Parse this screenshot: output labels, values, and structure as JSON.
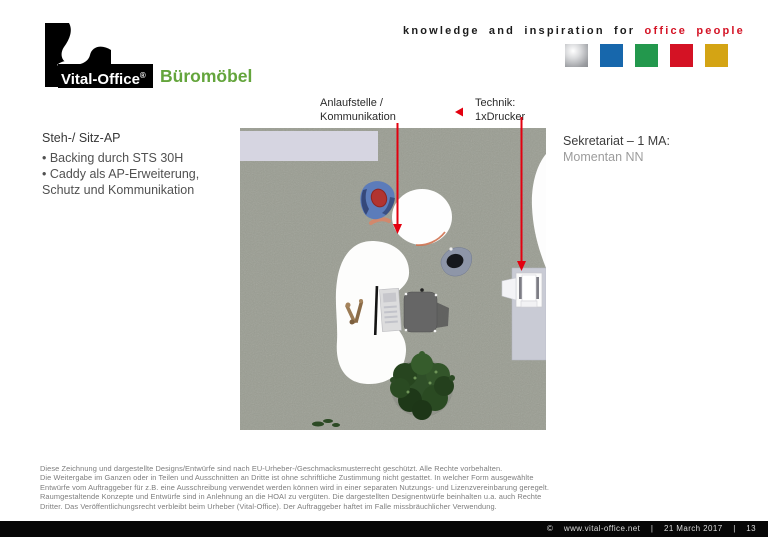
{
  "header": {
    "logo_brand": "Vital-Office",
    "logo_reg": "®",
    "logo_suffix": "Büromöbel",
    "tagline_black": "knowledge and inspiration for",
    "tagline_red": "office people",
    "palette_squares": [
      "silver",
      "blue",
      "green",
      "red",
      "gold"
    ]
  },
  "left_panel": {
    "title": "Steh-/ Sitz-AP",
    "lines": [
      "•  Backing durch STS 30H",
      "• Caddy als AP-Erweiterung,",
      "Schutz und Kommunikation"
    ]
  },
  "right_panel": {
    "title": "Sekretariat – 1 MA:",
    "subtitle": "Momentan NN"
  },
  "callouts": {
    "anlaufstelle_line1": "Anlaufstelle /",
    "anlaufstelle_line2": "Kommunikation",
    "technik_line1": "Technik:",
    "technik_line2": "1xDrucker"
  },
  "disclaimer": {
    "lines": [
      "Diese Zeichnung und dargestellte Designs/Entwürfe sind nach EU-Urheber-/Geschmacksmusterrecht geschützt. Alle Rechte vorbehalten.",
      "Die Weitergabe im Ganzen oder in Teilen und Ausschnitten an Dritte ist ohne schriftliche Zustimmung nicht gestattet. In welcher Form ausgewählte",
      "Entwürfe vom Auftraggeber für z.B. eine Ausschreibung verwendet werden können wird in einer separaten Nutzungs- und Lizenzvereinbarung geregelt.",
      "Raumgestaltende Konzepte und Entwürfe sind in Anlehnung an die HOAI zu vergüten. Die dargestellten Designentwürfe beinhalten u.a. auch Rechte",
      "Dritter. Das Veröffentlichungsrecht verbleibt beim Urheber (Vital-Office). Der Auftraggeber haftet im Falle missbräuchlicher Verwendung."
    ]
  },
  "footer": {
    "copyright_symbol": "©",
    "site": "www.vital-office.net",
    "sep": "|",
    "date": "21 March 2017",
    "page": "13"
  },
  "colors": {
    "brand_green": "#64a53c",
    "brand_red": "#d41224",
    "arrow_red": "#e3000f",
    "carpet": "#9a9d92",
    "wall_lavender": "#d6d5e1",
    "cabinet_gray": "#c9cbd5",
    "palette": [
      "#c7c8cb",
      "#1767ac",
      "#23984d",
      "#d41224",
      "#d4a414"
    ]
  }
}
